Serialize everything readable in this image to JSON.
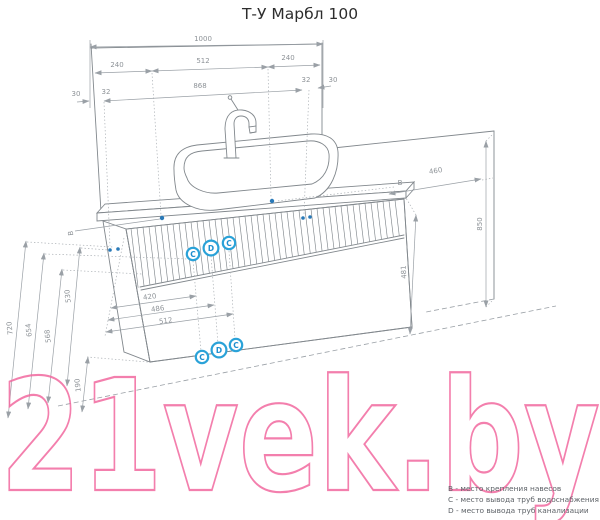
{
  "title": "Т-У Марбл 100",
  "watermark": "21vek.by",
  "legend": {
    "items": [
      "B - место крепления навесов",
      "C - место вывода труб водоснабжения",
      "D - место вывода труб канализации"
    ]
  },
  "badges": {
    "upper": [
      "C",
      "D",
      "C"
    ],
    "lower": [
      "C",
      "D",
      "C"
    ]
  },
  "dimensions": {
    "overall_width": "1000",
    "hanger_left_offset": "240",
    "hanger_span": "512",
    "hanger_right_offset": "240",
    "panel_width": "868",
    "edge_left_outer": "30",
    "edge_left_inner": "32",
    "edge_right_inner": "32",
    "edge_right_outer": "30",
    "depth": "460",
    "wall_height": "850",
    "cabinet_height": "481",
    "height_720": "720",
    "height_654": "654",
    "height_568": "568",
    "height_530": "530",
    "height_190": "190",
    "pipe_offset_1": "420",
    "pipe_offset_2": "486",
    "pipe_offset_3": "512",
    "hanger_label_left": "B",
    "hanger_label_right": "B"
  },
  "colors": {
    "line": "#82888d",
    "dim_line": "#9aa0a6",
    "accent_blue": "#2aa2d8",
    "mount_dot_blue": "#2a7ab8",
    "watermark_pink": "#f2699f"
  }
}
